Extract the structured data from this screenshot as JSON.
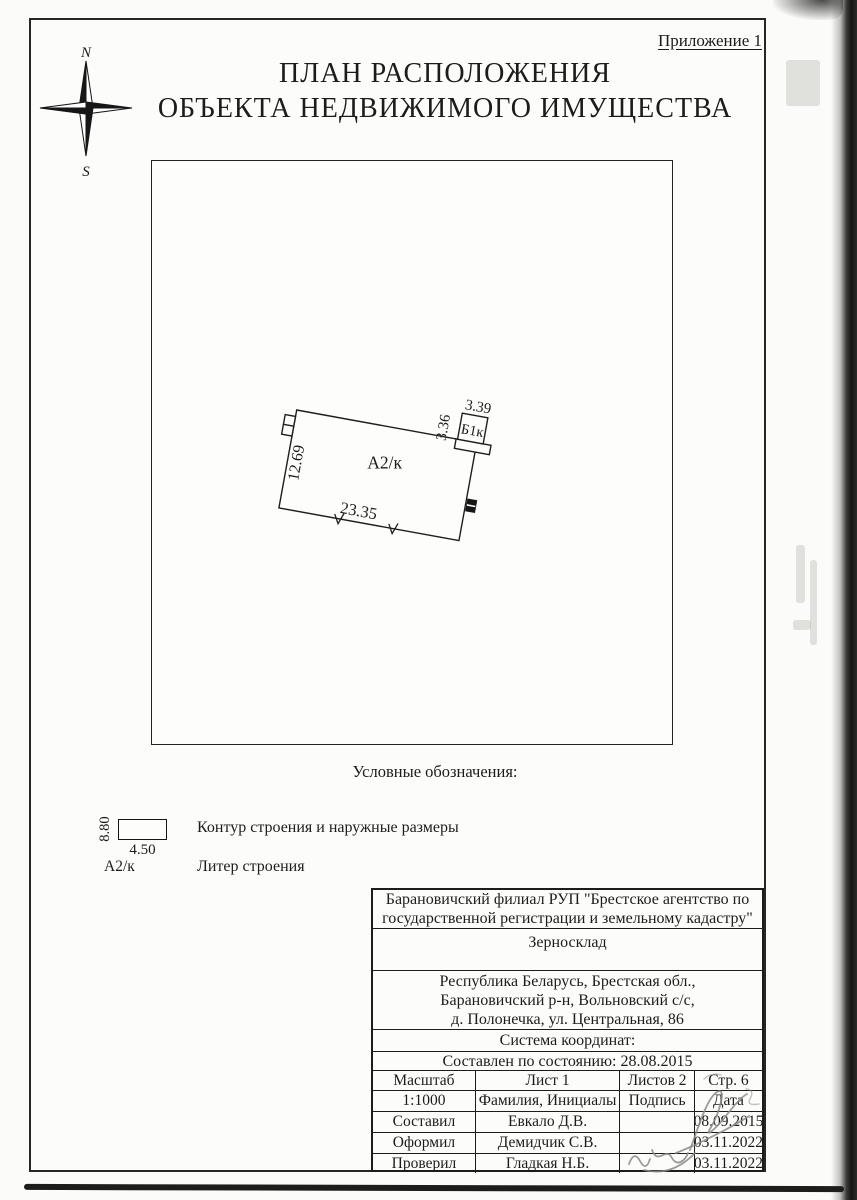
{
  "page": {
    "appendix_label": "Приложение 1"
  },
  "title": {
    "line1": "ПЛАН РАСПОЛОЖЕНИЯ",
    "line2": "ОБЪЕКТА НЕДВИЖИМОГО ИМУЩЕСТВА"
  },
  "compass": {
    "north": "N",
    "south": "S"
  },
  "plan": {
    "building_label": "А2/к",
    "annex_label": "Б1к",
    "dim_left": "12.69",
    "dim_bottom": "23.35",
    "dim_annex_side": "3.36",
    "dim_annex_top": "3.39"
  },
  "legend": {
    "title": "Условные обозначения:",
    "sample_height": "8.80",
    "sample_width": "4.50",
    "contour_label": "Контур строения  и наружные размеры",
    "liter_symbol": "А2/к",
    "liter_label": "Литер строения"
  },
  "title_block": {
    "organization_line1": "Барановичский филиал РУП \"Брестское агентство по",
    "organization_line2": "государственной регистрации и земельному кадастру\"",
    "object_name": "Зерносклад",
    "address_line1": "Республика Беларусь, Брестская обл.,",
    "address_line2": "Барановичский р-н, Вольновский с/с,",
    "address_line3": "д. Полонечка, ул. Центральная, 86",
    "coordinate_system": "Система координат:",
    "compiled": "Составлен по состоянию: 28.08.2015",
    "grid": {
      "header": {
        "c1": "Масштаб",
        "c2": "Лист 1",
        "c3": "Листов 2",
        "c4": "Стр. 6"
      },
      "subheader": {
        "c1": "1:1000",
        "c2": "Фамилия, Инициалы",
        "c3": "Подпись",
        "c4": "Дата"
      },
      "rows": [
        {
          "role": "Составил",
          "name": "Евкало Д.В.",
          "date": "08.09.2015"
        },
        {
          "role": "Оформил",
          "name": "Демидчик С.В.",
          "date": "03.11.2022"
        },
        {
          "role": "Проверил",
          "name": "Гладкая Н.Б.",
          "date": "03.11.2022"
        }
      ]
    }
  },
  "colors": {
    "ink": "#1c1c1c",
    "paper": "#fbfbf9",
    "signature": "#8a8a8a"
  }
}
